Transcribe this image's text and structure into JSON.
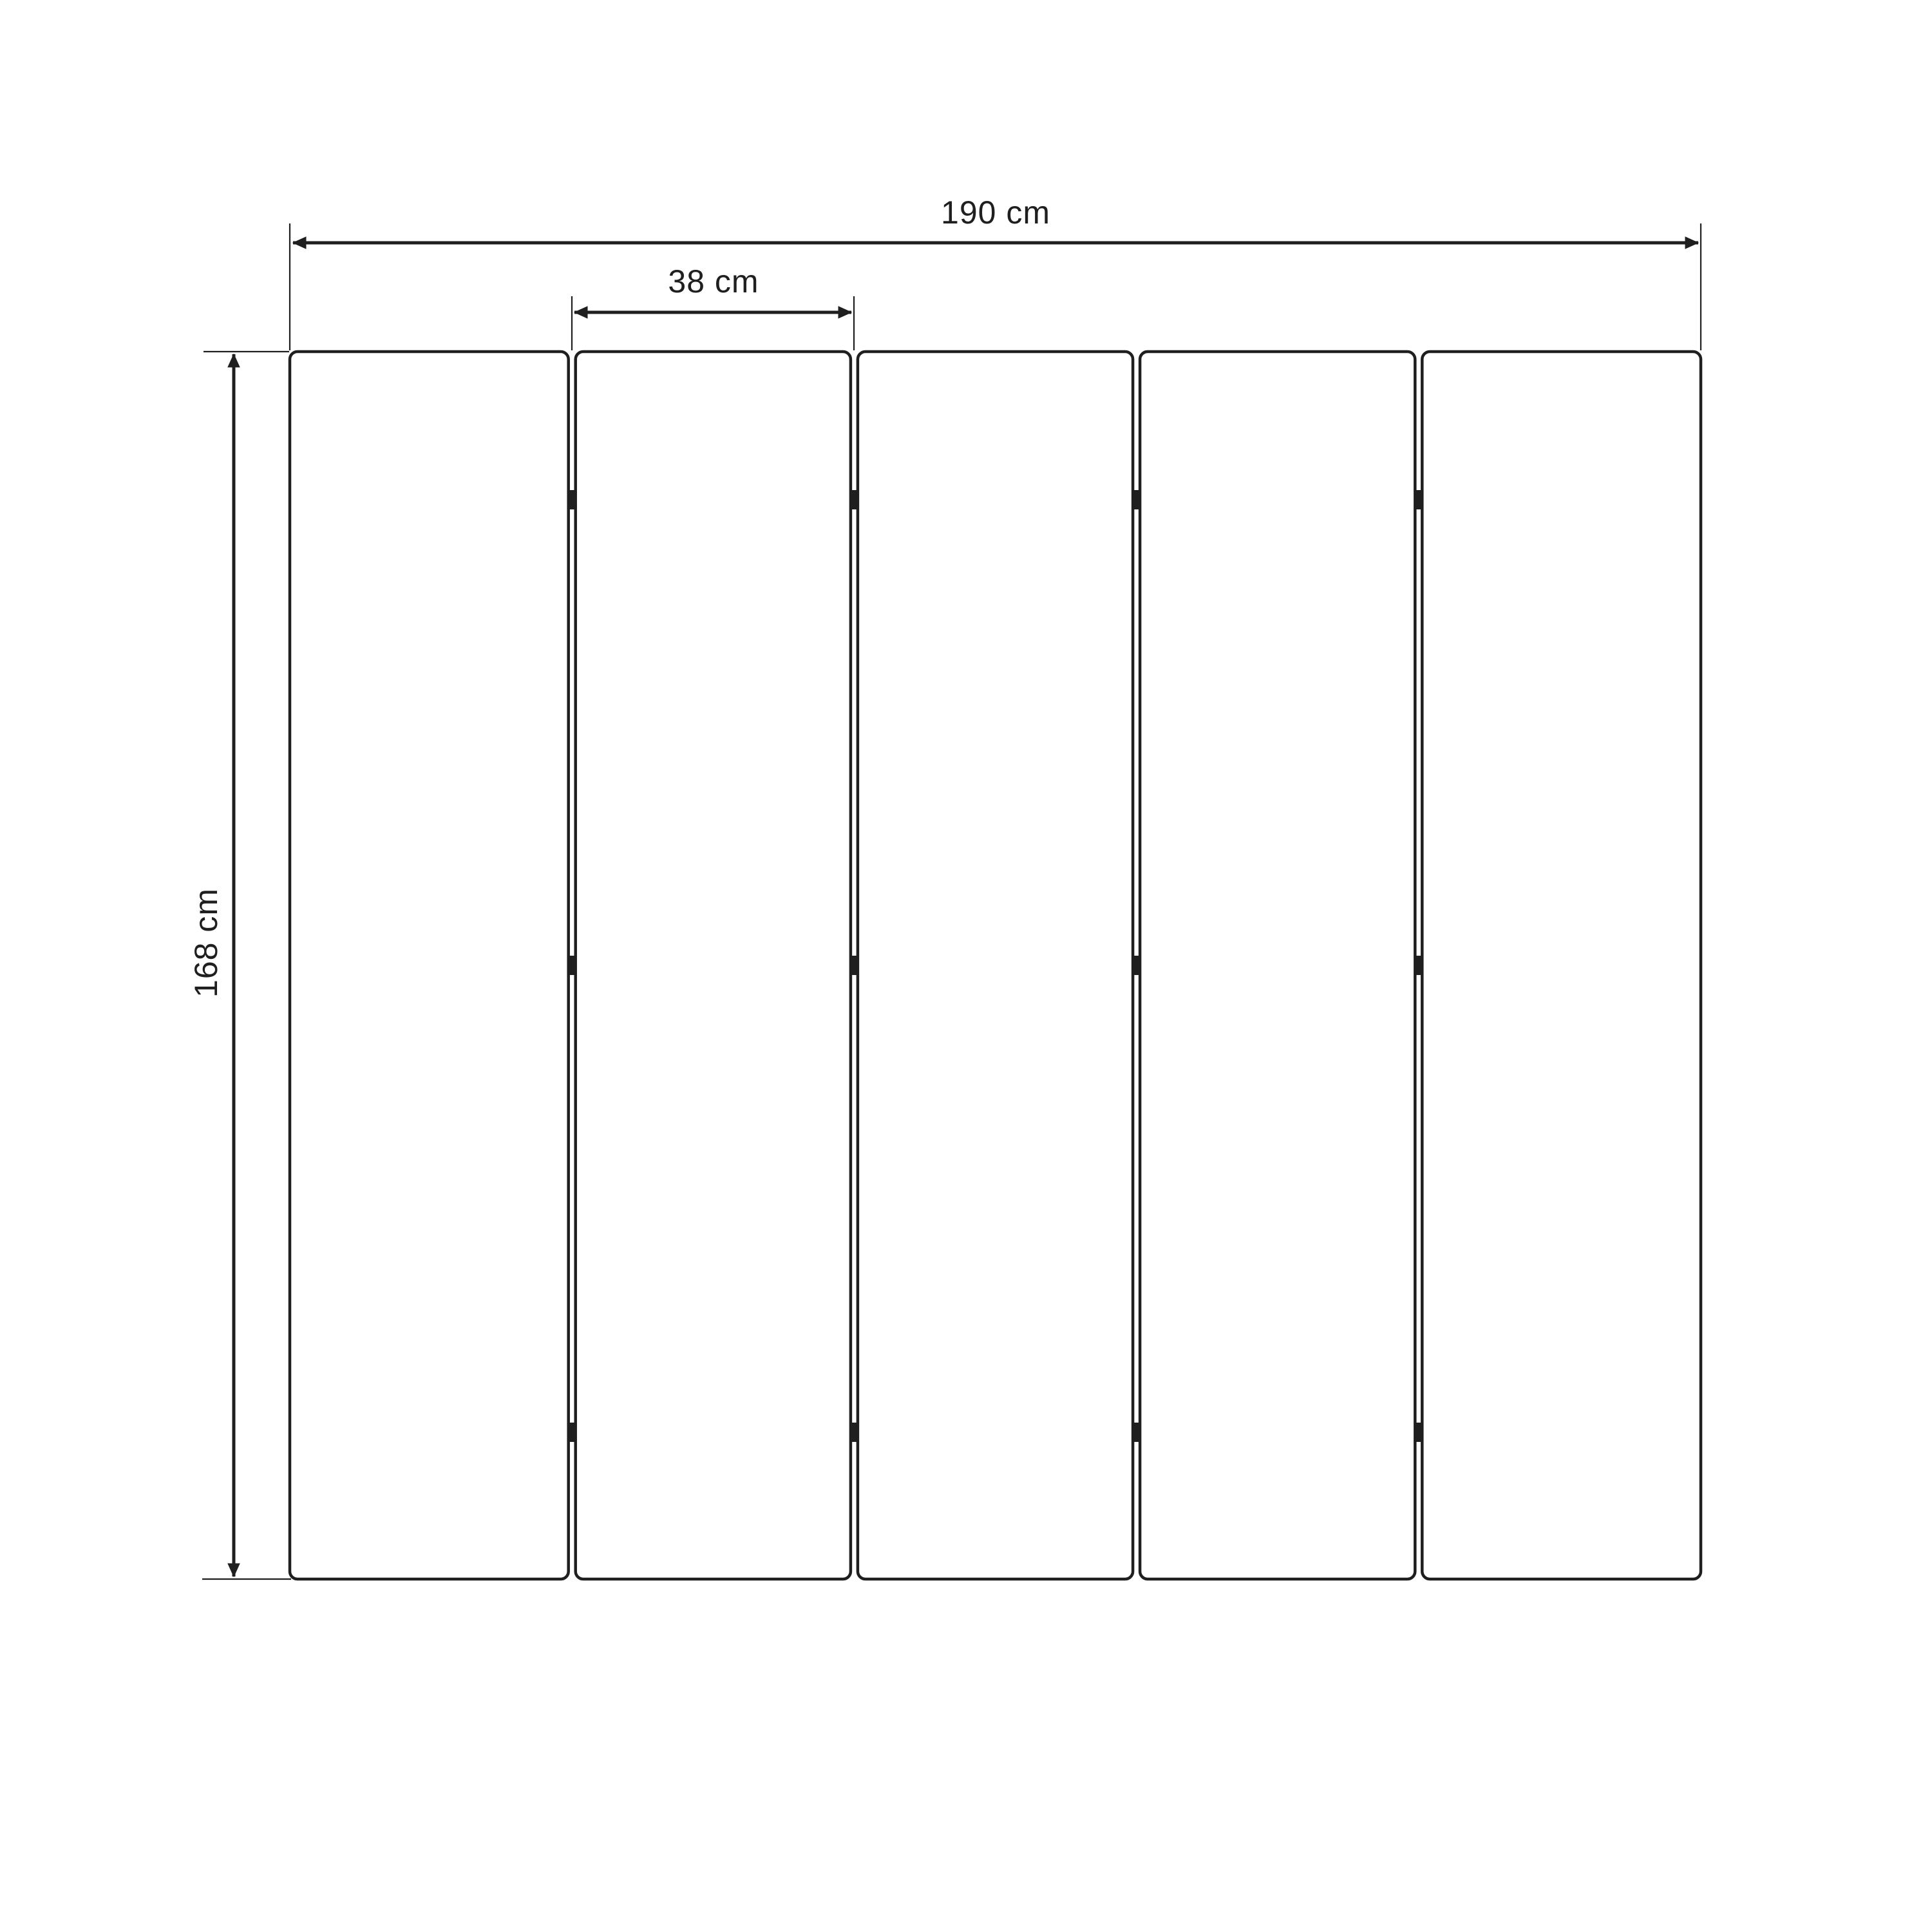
{
  "diagram": {
    "type": "technical-dimension-drawing",
    "subject": "five-panel folding screen front elevation",
    "panel_count": 5,
    "hinge_rows_per_gap": 3,
    "dimensions": {
      "total_width_label": "190 cm",
      "panel_width_label": "38 cm",
      "height_label": "168 cm"
    },
    "colors": {
      "line": "#1f1f1f",
      "panel_fill": "#ffffff",
      "background": "#ffffff"
    }
  }
}
